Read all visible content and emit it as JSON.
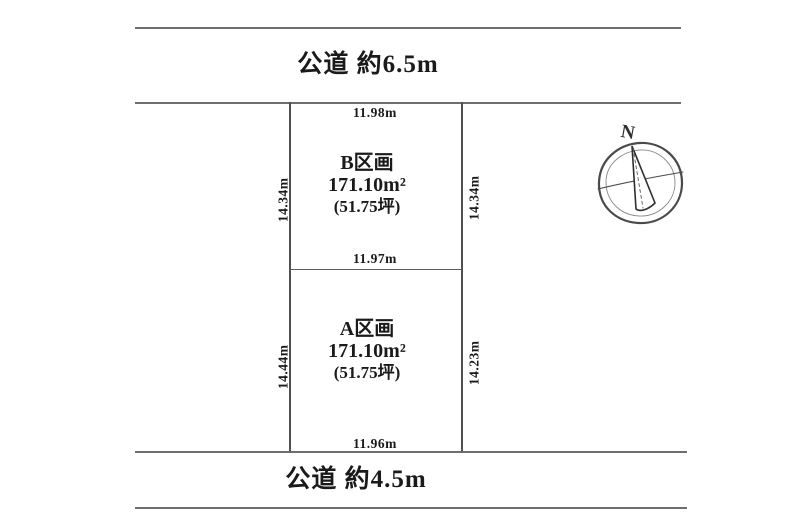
{
  "page": {
    "background": "#ffffff",
    "line_color": "#6e6e6e",
    "text_color": "#1a1a1a"
  },
  "roads": {
    "top": {
      "label": "公道 約6.5m"
    },
    "bottom": {
      "label": "公道 約4.5m"
    }
  },
  "plots": [
    {
      "id": "B",
      "name": "B区画",
      "area_m2": "171.10m²",
      "area_tsubo": "(51.75坪)",
      "top_dim": "11.98m",
      "bottom_dim": "11.97m",
      "left_dim": "14.34m",
      "right_dim": "14.34m"
    },
    {
      "id": "A",
      "name": "A区画",
      "area_m2": "171.10m²",
      "area_tsubo": "(51.75坪)",
      "bottom_dim": "11.96m",
      "left_dim": "14.44m",
      "right_dim": "14.23m"
    }
  ],
  "compass": {
    "label": "N"
  }
}
